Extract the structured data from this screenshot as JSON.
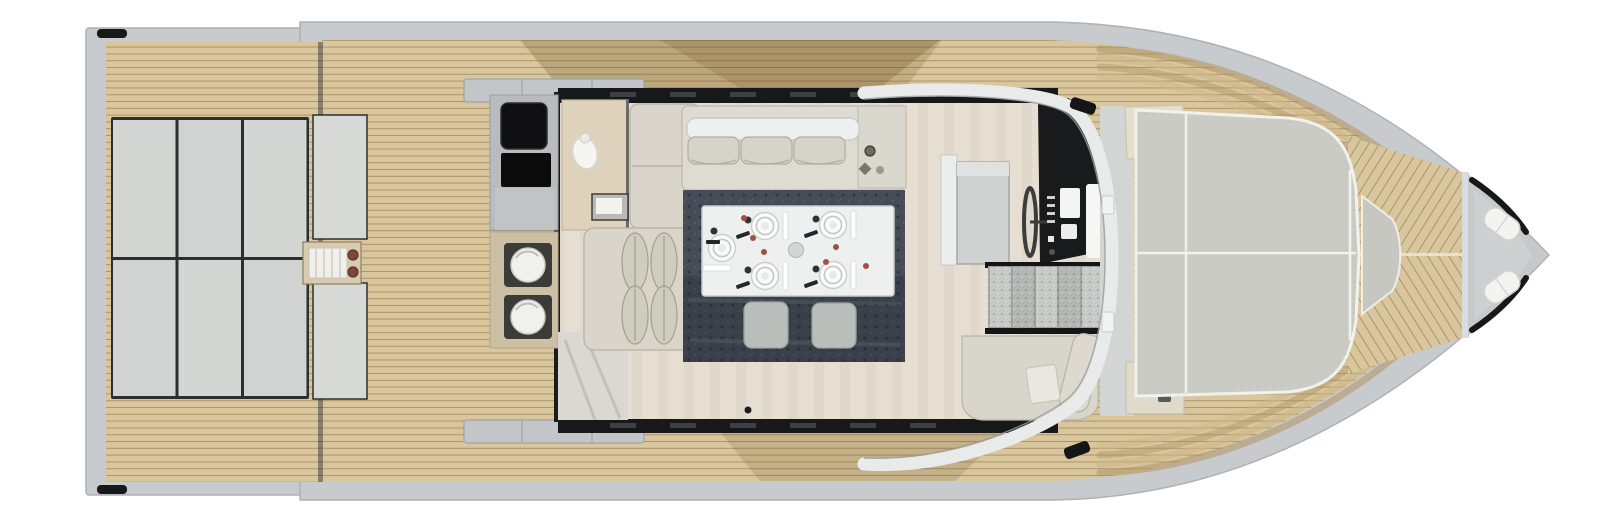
{
  "plan": {
    "type": "yacht-deck-plan",
    "view": "top-down",
    "canvas": {
      "width": 1600,
      "height": 523
    }
  },
  "colors": {
    "bg": "#ffffff",
    "hull": "#c8cbcd",
    "hull_edge": "#a9adaf",
    "teak": "#d9c69c",
    "teak_seam": "rgba(125,100,60,0.5)",
    "teak_shadow": "rgba(96,66,26,0.24)",
    "pad": "#d3d6d3",
    "pad_seam": "#2c2f31",
    "cushion": "#d9d5cb",
    "cushion_edge": "#b5b1a5",
    "floor": "#e5ded1",
    "black": "#17181a",
    "steel": "#b9bcbe",
    "counter_tan": "#cdbfa4",
    "stool_well": "#3b3b39",
    "white": "#f3f3f0",
    "rug": "#454c57",
    "table": "#eef0f0",
    "ottoman": "#babeba",
    "stair": "#c6c9c6",
    "stair_alt": "#b2b5b2",
    "wood_cabinet": "#ded2bc",
    "accent_brown": "#7c4638",
    "windshield": "#e9ebeb",
    "glass_edge": "#979c9e",
    "anchor_deck": "#c6c9ca"
  },
  "regions": {
    "swim_platform": {
      "name": "swim platform",
      "cleats": 2
    },
    "aft_sunpad": {
      "name": "aft sunpad",
      "panels": 6,
      "backrest_sections": 2
    },
    "boarding_ladder": {
      "name": "boarding ladder",
      "cap_dots": 2
    },
    "side_gates": {
      "count": 2
    },
    "galley": {
      "appliances": 2,
      "stools": 2,
      "sink": 1
    },
    "salon": {
      "aft_sofa_cushions": 3,
      "l_sofa_pillows": 4
    },
    "dining": {
      "plates": 5,
      "ottomans": 2,
      "red_specks": 6
    },
    "helm": {
      "screens": 3,
      "stair_steps": 5,
      "wheel": 1
    },
    "foredeck": {
      "speaker_dots": 3,
      "sunpad_sections": 3,
      "fenders": 2
    }
  }
}
